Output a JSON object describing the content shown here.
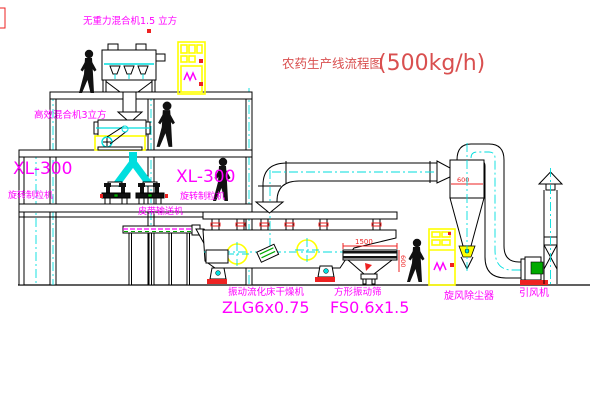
{
  "title": {
    "name": "农药生产线流程图",
    "capacity": "(500kg/h)"
  },
  "equipment_labels": {
    "gravity_free_mixer": "无重力混合机1.5 立方",
    "high_efficiency_mixer": "高效混合机3立方",
    "granulator_left_model": "XL-300",
    "granulator_left_name": "旋转制粒机",
    "granulator_mid_model": "XL-300",
    "granulator_mid_name": "旋转制粒机",
    "belt_conveyor": "皮带输送机",
    "fluid_bed_dryer_name": "振动流化床干燥机",
    "fluid_bed_dryer_model": "ZLG6x0.75",
    "square_sieve_name": "方形振动筛",
    "square_sieve_model": "FS0.6x1.5",
    "cyclone": "旋风除尘器",
    "induced_draft_fan": "引风机"
  },
  "dimensions": {
    "sieve_length": "1500",
    "sieve_width": "600",
    "cyclone_marking": "600"
  },
  "colors": {
    "label_magenta": "#ff00ff",
    "title_red": "#d94f4f",
    "annotation_red": "#ee2222",
    "cad_cyan": "#00dede",
    "highlight_yellow": "#ffff00",
    "accent_green": "#00aa00",
    "line_black": "#000000"
  }
}
